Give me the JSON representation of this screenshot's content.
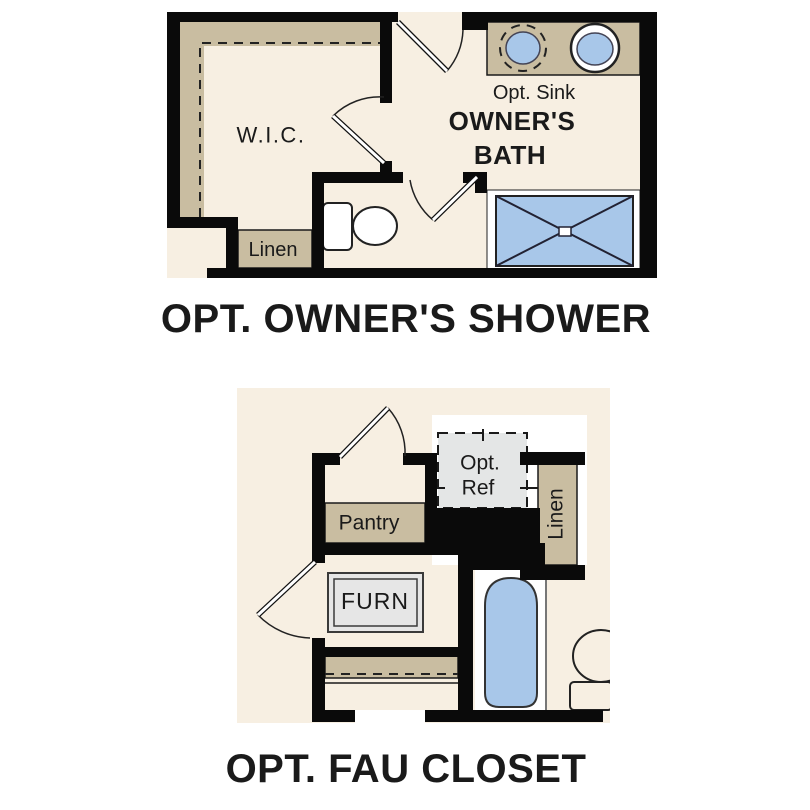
{
  "figure": {
    "colors": {
      "floor": "#f7efe2",
      "tan": "#c9bda1",
      "wall": "#0a0a0a",
      "blue": "#a8c7e9",
      "ref_gray": "#e4e6e6",
      "furn_gray": "#e6e6e6",
      "white": "#ffffff"
    },
    "plans": {
      "owners_shower": {
        "title": "OPT. OWNER'S SHOWER",
        "labels": {
          "wic": "W.I.C.",
          "linen": "Linen",
          "opt_sink": "Opt. Sink",
          "bath_line1": "OWNER'S",
          "bath_line2": "BATH"
        }
      },
      "fau_closet": {
        "title": "OPT. FAU CLOSET",
        "labels": {
          "pantry": "Pantry",
          "ref_line1": "Opt.",
          "ref_line2": "Ref",
          "linen": "Linen",
          "furnace": "FURN"
        }
      }
    }
  }
}
